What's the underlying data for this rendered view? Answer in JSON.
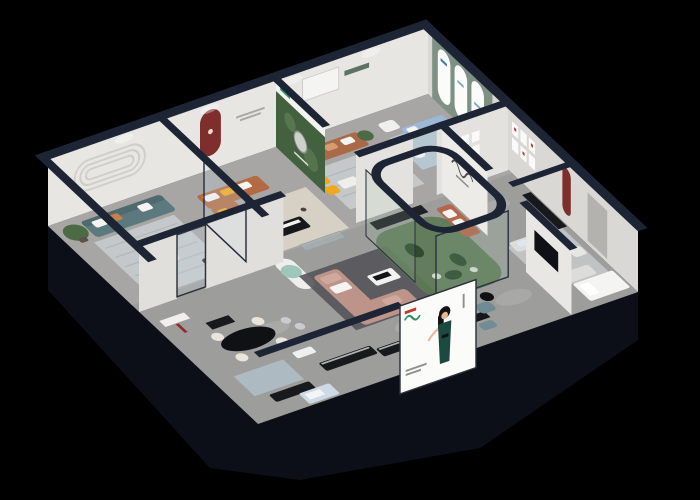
{
  "scene": {
    "background": "#000000",
    "width": 700,
    "height": 500
  },
  "palette": {
    "navy": "#1d2433",
    "plinth": "#0c0f17",
    "outer_wall": "#171c28",
    "wall_face": "#e7e6e2",
    "wall_face_shaded": "#d9d8d4",
    "floor": "#9d9d9b",
    "floor_bright": "#b3b2af",
    "rug_gray": "#c9ccce",
    "rug_beige": "#d8d3c6",
    "rug_blue": "#b8cddb",
    "rug_charcoal": "#55545a",
    "sofa_teal": "#5c7a7d",
    "sofa_caramel": "#b26b42",
    "sofa_brown": "#a96a48",
    "sofa_pink": "#bd9489",
    "sofa_blue": "#9db7d6",
    "sofa_light": "#dcdcda",
    "sofa_terracotta": "#b5664d",
    "armchair_teal": "#6f8b93",
    "accent_yellow": "#f2a71d",
    "niche_red": "#7e2f2c",
    "green_wall": "#7e9184",
    "mural_green": "#44613f",
    "terrarium_green": "#5d7a55",
    "plant_green": "#4c6b45",
    "table_black": "#17181b",
    "table_white": "#f2f1ee",
    "console_black": "#17191c",
    "billboard_white": "#fbfbfa",
    "dress_green": "#1d4a40",
    "logo_green": "#2f8e68",
    "logo_red": "#c0392b",
    "bed_white": "#f4f4f3",
    "skin": "#eab795",
    "door_gray": "#b4b2ae",
    "pillow_white": "#f4f4f2"
  },
  "glass": {
    "tint": "rgba(205,222,232,0.22)",
    "terrarium_tint": "rgba(150,190,160,0.16)"
  }
}
